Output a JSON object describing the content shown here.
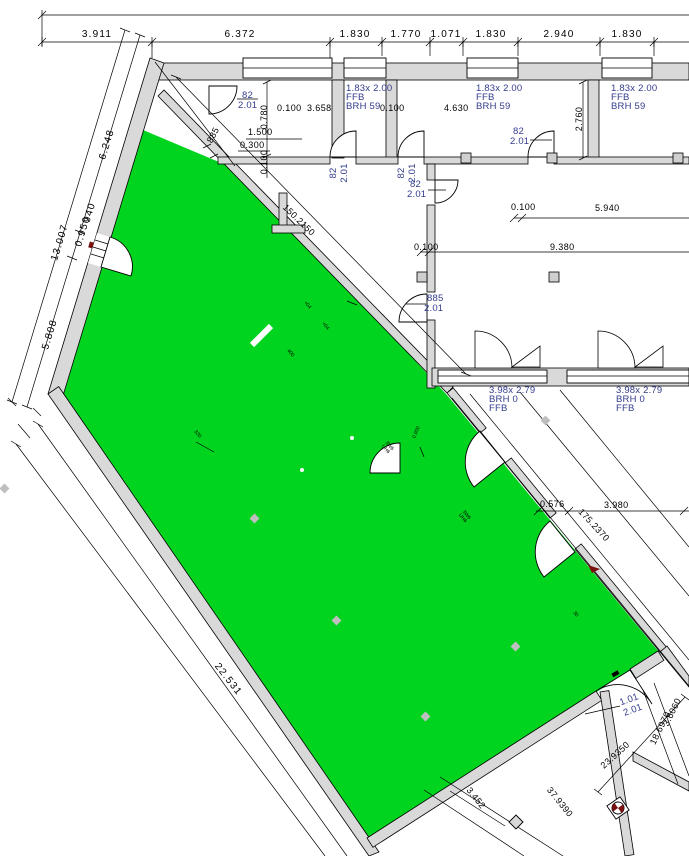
{
  "colors": {
    "highlight_green": "#00d41e",
    "wall_fill": "#d9d9d9",
    "label_blue": "#333c8c",
    "line_black": "#000000"
  },
  "top_chain": [
    "3.911",
    "6.372",
    "1.830",
    "1.770",
    "1.071",
    "1.830",
    "2.940",
    "1.830"
  ],
  "left_chain": {
    "overall": "13.007",
    "upper": "6.248",
    "door_width": "0.950",
    "door_clear": "940",
    "lower": "5.808",
    "bottom": "22.531"
  },
  "top_windows": [
    {
      "size": "1.83x 2.00",
      "line2": "FFB",
      "line3": "BRH 59"
    },
    {
      "size": "1.83x 2.00",
      "line2": "FFB",
      "line3": "BRH 59"
    },
    {
      "size": "1.83x 2.00",
      "line2": "FFB",
      "line3": "BRH 59"
    }
  ],
  "mid_windows": [
    {
      "size": "3.98x 2.79",
      "line2": "BRH 0",
      "line3": "FFB"
    },
    {
      "size": "3.98x 2.79",
      "line2": "BRH 0",
      "line3": "FFB"
    }
  ],
  "doors": {
    "a": {
      "w": "82",
      "h": "2.01"
    },
    "b": {
      "w": "82",
      "h": "2.01"
    },
    "c": {
      "w": "82",
      "h": "2.01"
    },
    "d": {
      "w": "82",
      "h": "2.01"
    },
    "e": {
      "w": "82",
      "h": "2.01"
    },
    "f": {
      "w": "885",
      "h": "2.01"
    },
    "g": {
      "w": "1.01",
      "h": "2.01"
    }
  },
  "interior_dims": {
    "v_0780": "0.780",
    "h_0100_a": "0.100",
    "h_3658": "3.658",
    "h_0100_b": "0.100",
    "h_4630": "4.630",
    "v_2760": "2.760",
    "h_1500": "1.500",
    "h_0300": "0.300",
    "v_0100": "0.100",
    "h_0100_c": "0.100",
    "h_5940": "5.940",
    "h_0100_d": "0.100",
    "h_9380": "9.380",
    "w_885": "885",
    "diag_150": "150.2150",
    "h_0576": "0.576",
    "h_3980": "3.980",
    "diag_175": "175.2370",
    "diag_23": "23.9350",
    "diag_37": "37.9390",
    "diag_18": "18.6970",
    "diag_36": "3.6060",
    "diag_34": "3.452"
  },
  "micro_marks": {
    "m1": "320",
    "m2": "+04",
    "m3": "+04",
    "m4": "400",
    "m5": "0.900",
    "m6": "30",
    "c1a": "3W6",
    "c1b": "UH6",
    "c2a": "3W6",
    "c2b": "UH6"
  }
}
